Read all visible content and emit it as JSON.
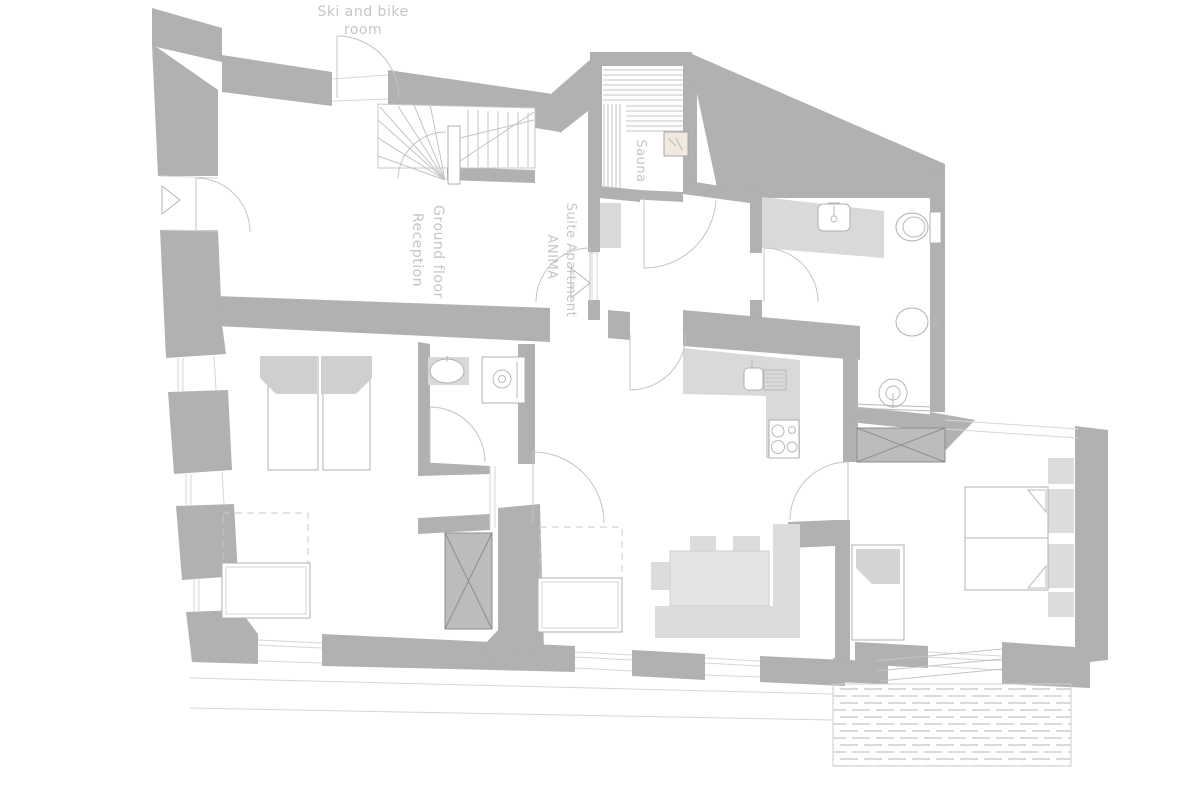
{
  "labels": {
    "ski_bike_line1": "Ski and bike",
    "ski_bike_line2": "room",
    "ground_floor_line1": "Ground floor",
    "ground_floor_line2": "Reception",
    "suite_line1": "Suite Apartment",
    "suite_line2": "ANIMA",
    "sauna": "Sauna"
  },
  "colors": {
    "background": "#ffffff",
    "wall": "#b1b1b1",
    "wall_dark_line": "#8d8d8d",
    "furniture_fill": "#dcdcdc",
    "counter_fill": "#d9d9d9",
    "outline": "#c4c4c4",
    "label_text": "#c6c6c6",
    "thin_line": "#d6d6d6"
  }
}
